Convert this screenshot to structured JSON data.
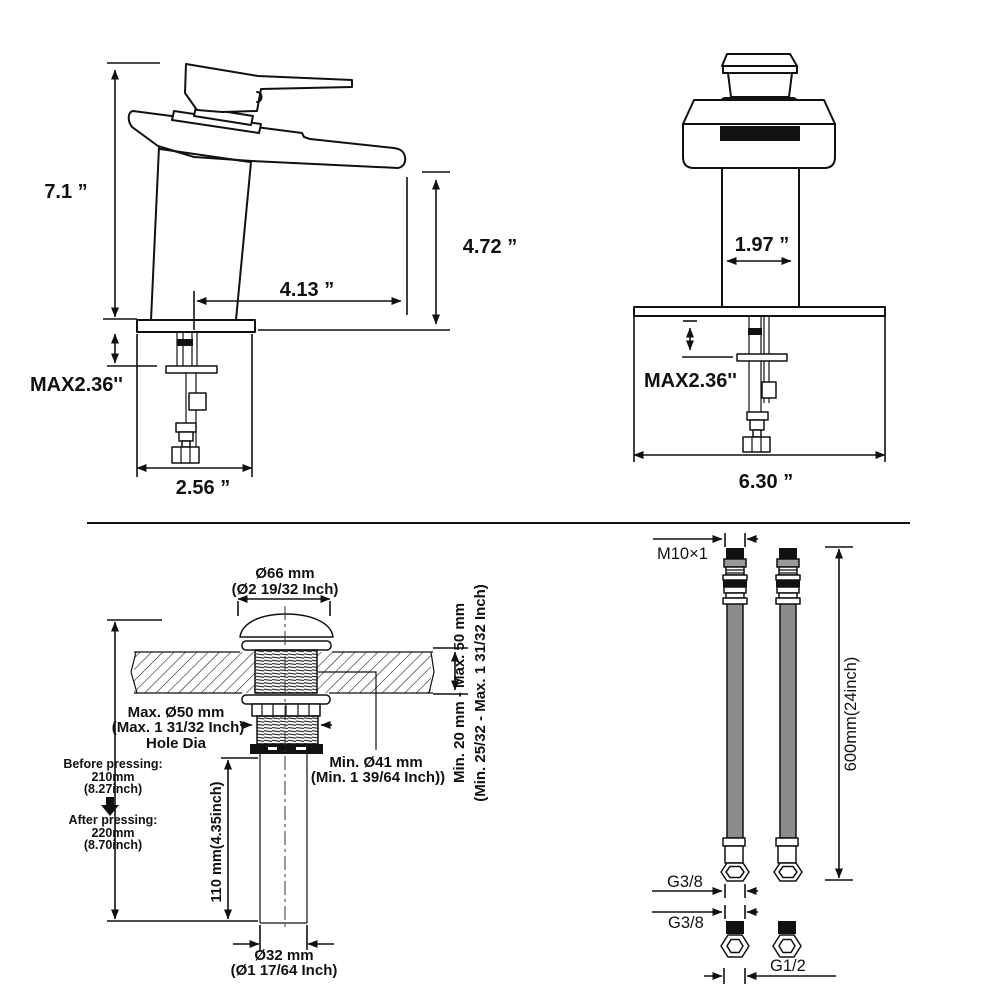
{
  "title": "Waterfall faucet installation dimension diagram",
  "side_view": {
    "height": "7.1 ”",
    "spout_height": "4.72 ”",
    "spout_reach": "4.13 ”",
    "below_deck_max": "MAX2.36''",
    "base_width": "2.56 ”"
  },
  "front_view": {
    "body_width": "1.97 ”",
    "below_deck_max": "MAX2.36''",
    "plate_width": "6.30 ”"
  },
  "drain_view": {
    "cap_dia_mm": "Ø66 mm",
    "cap_dia_in": "(Ø2 19/32 Inch)",
    "hole_dia_mm": "Max. Ø50 mm",
    "hole_dia_in": "(Max. 1 31/32 Inch)",
    "hole_dia_label": "Hole Dia",
    "min_dia_mm": "Min. Ø41 mm",
    "min_dia_in": "(Min. 1 39/64 Inch))",
    "deck_thickness_mm": "Min. 20 mm - Max. 50 mm",
    "deck_thickness_in": "(Min. 25/32 - Max. 1 31/32 Inch)",
    "before_pressing_label": "Before pressing:",
    "before_pressing_mm": "210mm",
    "before_pressing_in": "(8.27inch)",
    "after_pressing_label": "After pressing:",
    "after_pressing_mm": "220mm",
    "after_pressing_in": "(8.70inch)",
    "tailpipe_length": "110 mm(4.35inch)",
    "tailpipe_dia_mm": "Ø32 mm",
    "tailpipe_dia_in": "(Ø1 17/64 Inch)"
  },
  "hose_view": {
    "top_thread": "M10×1",
    "hose_length": "600mm(24inch)",
    "hose_nut_thread": "G3/8",
    "hose_nut_thread_2": "G3/8",
    "adapter_thread": "G1/2"
  },
  "colors": {
    "line": "#111111",
    "hose_gray": "#8c8c8c",
    "fitting_gray": "#9a9a9a",
    "black_fill": "#111111",
    "background": "#ffffff"
  }
}
